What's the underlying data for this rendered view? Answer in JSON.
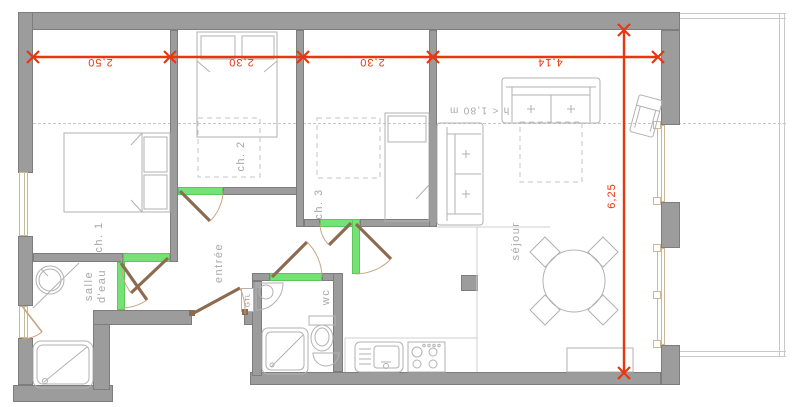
{
  "plan": {
    "rooms": {
      "ch1": "ch. 1",
      "ch2": "ch. 2",
      "ch3": "ch. 3",
      "sejour": "séjour",
      "entree": "entrée",
      "salle_eau": "salle d'eau",
      "wc": "wc",
      "gtl": "GTL"
    },
    "annotations": {
      "height_note": "h < 1,80 m"
    },
    "dimensions": {
      "ch1_width": "2,50",
      "ch2_width": "2,30",
      "ch3_width": "2,30",
      "sejour_width": "4,14",
      "depth": "6,25"
    }
  },
  "colors": {
    "dimension_red": "#e8360f",
    "door_green": "#76e276",
    "door_leaf_brown": "#8d6b50",
    "door_arc_tan": "#c9a584",
    "wall_gray": "#9c9c9c",
    "wall_edge": "#7d7d7d",
    "window_tan": "#cbb894",
    "furniture_gray": "#b2b2b2",
    "label_gray": "#a8a8a8",
    "dashed_gray": "#c6c6c6"
  }
}
